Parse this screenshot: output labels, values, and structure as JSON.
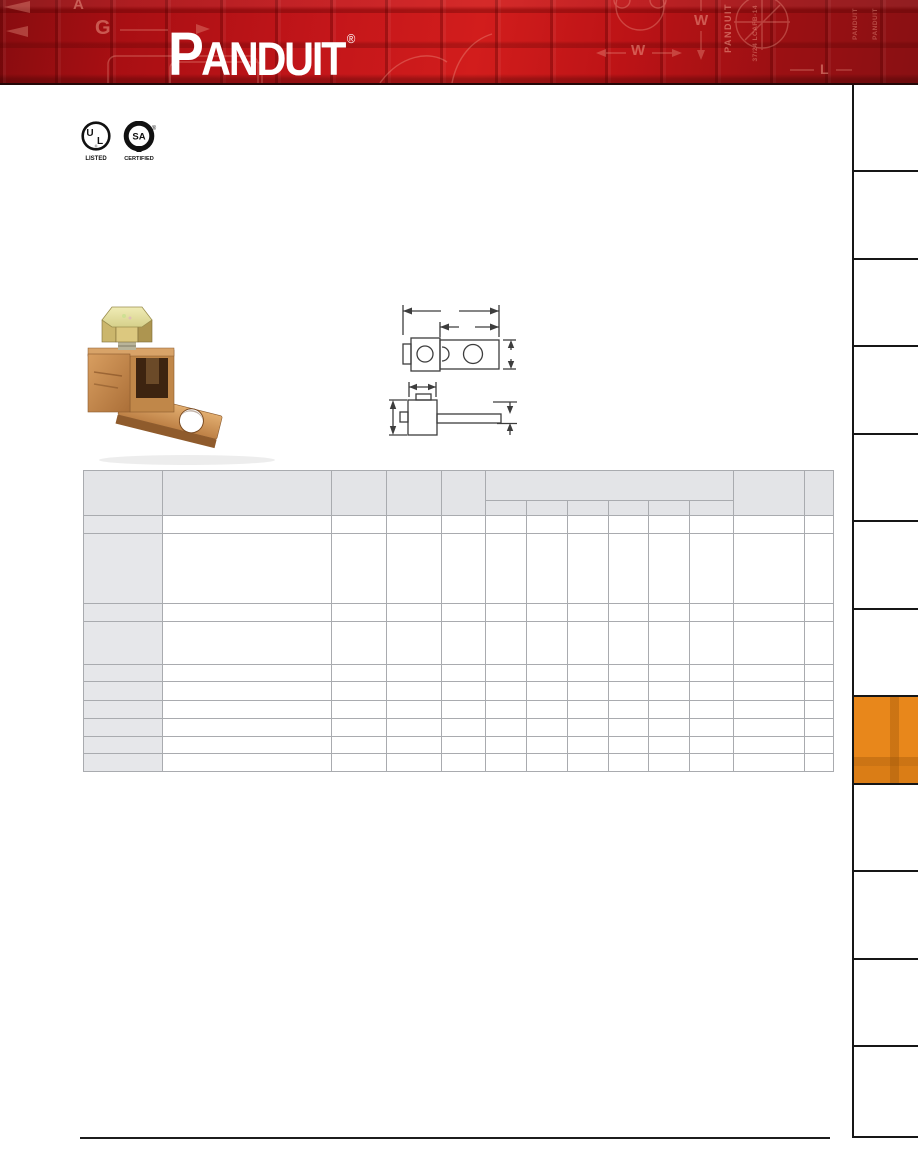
{
  "page": {
    "background": "#ffffff",
    "width_px": 918,
    "height_px": 1175
  },
  "header": {
    "brand": "PANDUIT",
    "brand_first": "P",
    "brand_rest": "ANDUIT",
    "registered_mark": "®",
    "colors": {
      "base_red": "#c4161a",
      "dark_red": "#870c0f",
      "logo": "#ffffff"
    },
    "watermarks": {
      "a": "A",
      "g": "G",
      "w": "W",
      "l": "L",
      "vertical_brand": "PANDUIT",
      "vertical_part": "37/24 LCAFB-14"
    }
  },
  "certifications": {
    "ul": {
      "mark": "UL",
      "caption": "LISTED"
    },
    "csa": {
      "mark": "CSA",
      "caption": "CERTIFIED",
      "registered_mark": "®"
    }
  },
  "figures": {
    "product_photo": "copper mechanical lug with hex-head screw",
    "dimension_drawing": "dimensioned top and side line views"
  },
  "table": {
    "column_widths_px": [
      79,
      169,
      55,
      55,
      44,
      41,
      41,
      41,
      40,
      41,
      44,
      71,
      29
    ],
    "header": {
      "top_row_height_px": 30,
      "sub_row_height_px": 15,
      "group_start_col": 5,
      "group_col_count": 6,
      "cells_blank": true
    },
    "row_heights_px": [
      18,
      70,
      18,
      43,
      17,
      19,
      18,
      18,
      17,
      18
    ],
    "cells_blank": true,
    "header_fill": "#e3e4e7",
    "stub_fill": "#e6e7ea",
    "grid_color": "#a9abaf"
  },
  "sidebar": {
    "tab_heights_px": [
      87,
      88,
      87,
      88,
      87,
      88,
      87,
      88,
      87,
      88,
      87,
      91
    ],
    "active_index": 7,
    "active_color": "#e8871b",
    "line_color": "#161616",
    "tabs_blank": true
  },
  "footer": {
    "rule_color": "#1c1c1c"
  }
}
